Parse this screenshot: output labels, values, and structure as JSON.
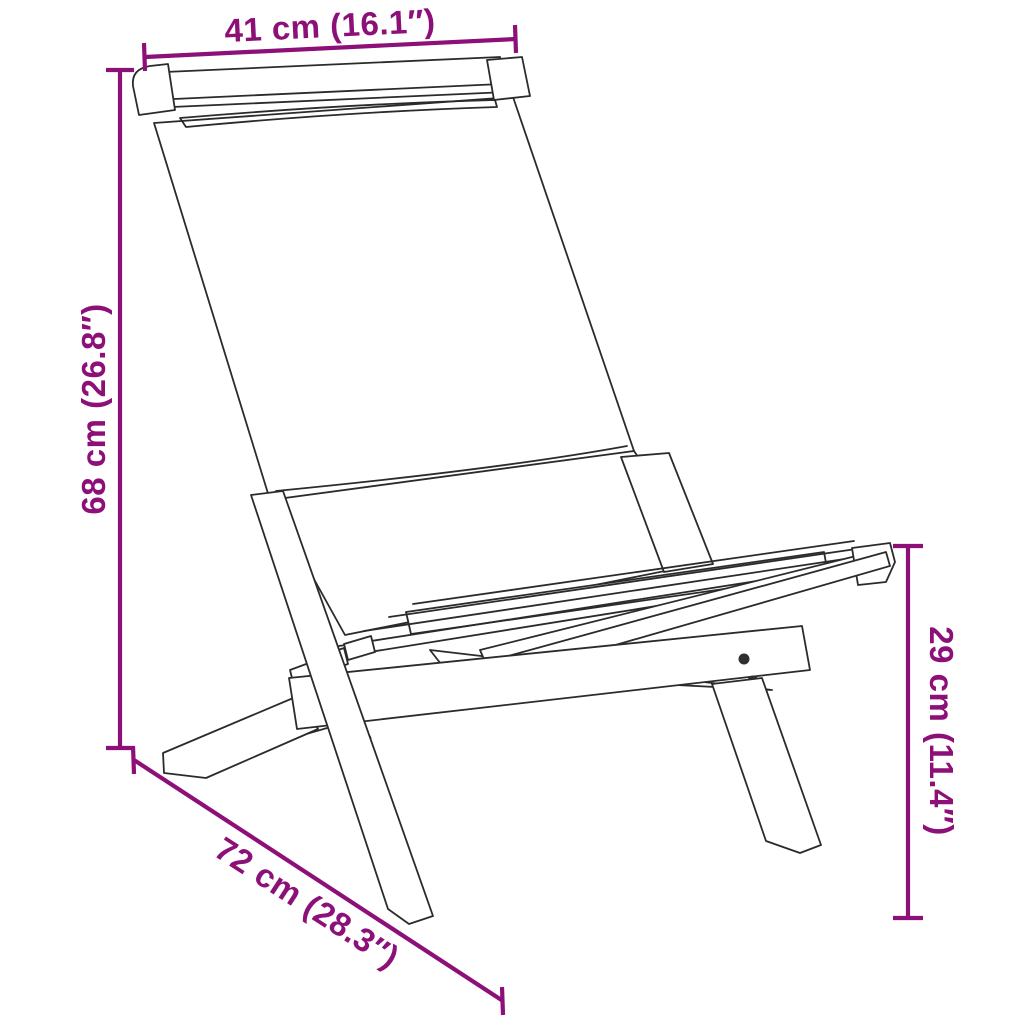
{
  "diagram": {
    "background_color": "#ffffff",
    "accent_color": "#8C1078",
    "outline_color": "#2b2b2b",
    "subject": "folding-chair-line-drawing",
    "measurements": {
      "width": {
        "label": "41 cm (16.1″)",
        "cm": 41,
        "inches": 16.1
      },
      "height": {
        "label": "68 cm (26.8″)",
        "cm": 68,
        "inches": 26.8
      },
      "seat_height": {
        "label": "29 cm (11.4″)",
        "cm": 29,
        "inches": 11.4
      },
      "depth": {
        "label": "72 cm (28.3″)",
        "cm": 72,
        "inches": 28.3
      }
    }
  }
}
